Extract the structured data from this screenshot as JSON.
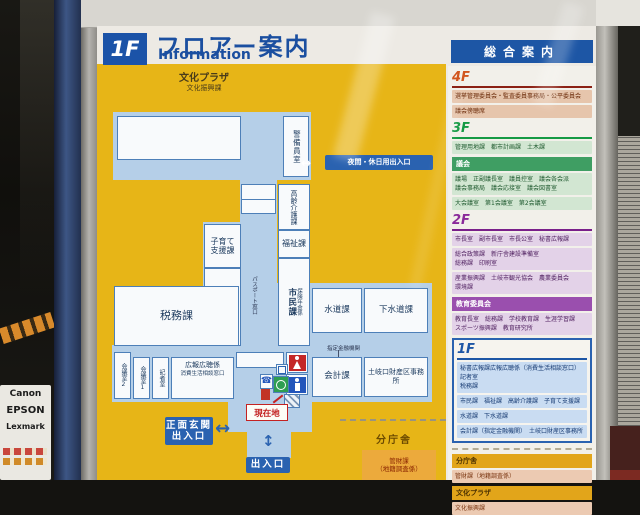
{
  "surroundings": {
    "printer_box_brands": [
      "Canon",
      "EPSON",
      "Lexmark"
    ]
  },
  "sign": {
    "floor_badge": "1F",
    "title": "フロアー案内",
    "title_en": "Information",
    "plaza_name": "文化プラザ",
    "plaza_dept": "文化振興課"
  },
  "map": {
    "rooms": {
      "security_office": "警備員室",
      "elderly_care": "高齢介護課",
      "child_support": "子育て支援課",
      "citizen_division": "市民課",
      "resident_section": "住民係",
      "welfare": "福祉課",
      "citizen_division2": "市民課",
      "insurance_pension_section": "保険年金係",
      "tax_division": "税務課",
      "water_division": "水道課",
      "sewer_division": "下水道課",
      "meeting_room2": "会議室2",
      "meeting_room1": "会議室1",
      "press_room": "記者室",
      "pr_section": "広報広聴係",
      "consumer_counter": "消費生活相談窓口",
      "accounting_division": "会計課",
      "tokiguchi_office": "土岐口財産区事務所"
    },
    "labels": {
      "night_entrance": "夜間・休日用出入口",
      "passport_counter": "パスポート窓口",
      "designated_bank": "指定金融機関",
      "current_location": "現在地",
      "main_entrance_line1": "正面玄関",
      "main_entrance_line2": "出入口",
      "south_entrance": "出入口",
      "annex_title": "分庁舎",
      "annex_dept_line1": "管財課",
      "annex_dept_line2": "（地籍調査係）"
    },
    "icons": {
      "night_entrance_arrow": "↔",
      "main_entrance_arrow": "↔",
      "south_entrance_arrow": "↕",
      "phone": "☎"
    }
  },
  "directory": {
    "title": "総合案内",
    "f4": {
      "label": "4F",
      "rows": [
        "選挙管理委員会・監査委員事務局・公平委員会",
        "議会傍聴席"
      ]
    },
    "f3": {
      "label": "3F",
      "rows": [
        "管理用地課　都市計画課　土木課"
      ]
    },
    "council": {
      "label": "議会",
      "rows": [
        "議場　正副議長室　議員控室　議会各会派\n議会事務局　議会応接室　議会図書室",
        "大会議室　第1会議室　第2会議室"
      ]
    },
    "f2": {
      "label": "2F",
      "rows": [
        "市長室　副市長室　市長公室　秘書広報課",
        "総合政策課　新庁舎建設準備室\n総務課　印刷室",
        "産業振興課　土岐市観光協会　農業委員会\n環境課"
      ]
    },
    "education": {
      "label": "教育委員会",
      "rows": [
        "教育長室　総務課　学校教育課　生涯学習課\nスポーツ振興課　教育研究所"
      ]
    },
    "f1": {
      "label": "1F",
      "rows": [
        "秘書広報課広報広聴係（消費生活相談窓口）　記者室\n税務課",
        "市民課　福祉課　高齢介護課　子育て支援課",
        "水道課　下水道課",
        "会計課（指定金融機関）　土岐口財産区事務所"
      ]
    },
    "annex": {
      "label": "分庁舎",
      "rows": [
        "管財課（地籍調査係）"
      ]
    },
    "plaza": {
      "label": "文化プラザ",
      "rows": [
        "文化振興課"
      ]
    }
  }
}
